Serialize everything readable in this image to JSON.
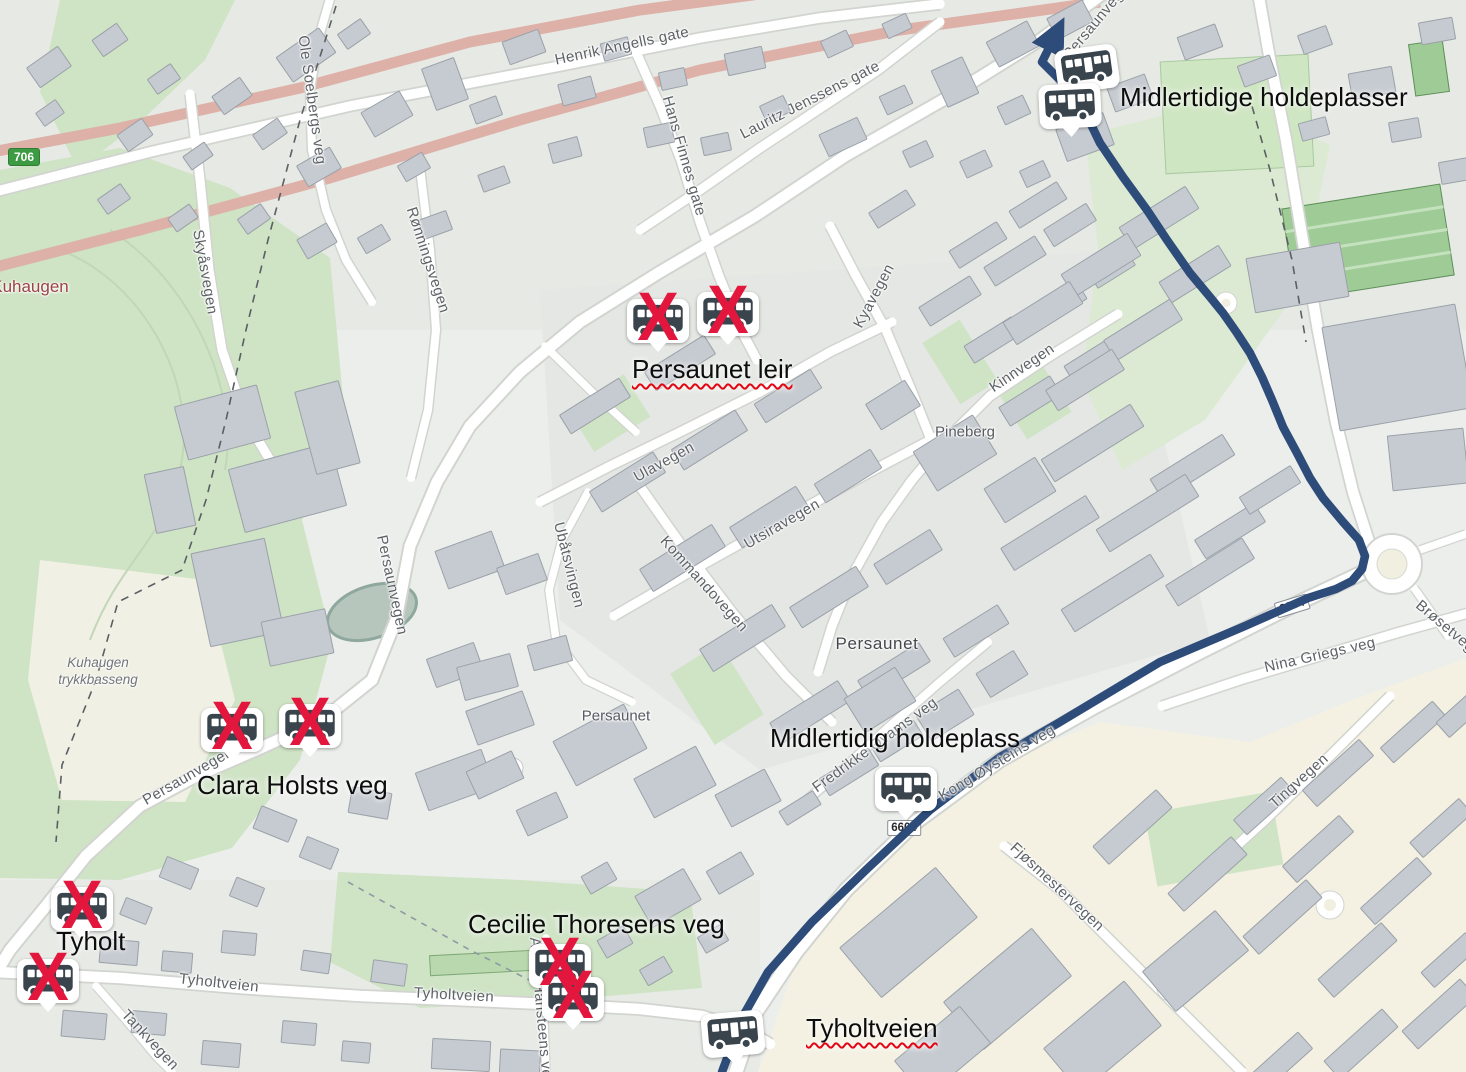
{
  "annotations": [
    {
      "text": "Midlertidige holdeplasser",
      "x": 1120,
      "y": 82,
      "spellcheck": false
    },
    {
      "text": "Persaunet leir",
      "x": 632,
      "y": 354,
      "spellcheck": true
    },
    {
      "text": "Clara Holsts veg",
      "x": 197,
      "y": 770,
      "spellcheck": false
    },
    {
      "text": "Midlertidig holdeplass",
      "x": 770,
      "y": 723,
      "spellcheck": false
    },
    {
      "text": "Tyholt",
      "x": 56,
      "y": 926,
      "spellcheck": false
    },
    {
      "text": "Cecilie Thoresens veg",
      "x": 468,
      "y": 909,
      "spellcheck": false
    },
    {
      "text": "Tyholtveien",
      "x": 806,
      "y": 1013,
      "spellcheck": true
    }
  ],
  "bus_stops": [
    {
      "x": 1087,
      "y": 69,
      "crossed": false,
      "rot": -8
    },
    {
      "x": 1070,
      "y": 106,
      "crossed": false,
      "rot": -3
    },
    {
      "x": 658,
      "y": 321,
      "crossed": true,
      "rot": 0
    },
    {
      "x": 728,
      "y": 314,
      "crossed": true,
      "rot": 0
    },
    {
      "x": 232,
      "y": 730,
      "crossed": true,
      "rot": 0
    },
    {
      "x": 310,
      "y": 726,
      "crossed": true,
      "rot": 0
    },
    {
      "x": 82,
      "y": 909,
      "crossed": true,
      "rot": 0
    },
    {
      "x": 48,
      "y": 981,
      "crossed": true,
      "rot": 0
    },
    {
      "x": 560,
      "y": 966,
      "crossed": true,
      "rot": 0
    },
    {
      "x": 573,
      "y": 999,
      "crossed": true,
      "rot": 0
    },
    {
      "x": 906,
      "y": 789,
      "crossed": false,
      "rot": 0
    },
    {
      "x": 733,
      "y": 1034,
      "crossed": false,
      "rot": -5
    }
  ],
  "street_labels": [
    {
      "text": "Henrik Angells gate",
      "x": 622,
      "y": 46,
      "rot": -12
    },
    {
      "text": "Hans Finnes gate",
      "x": 684,
      "y": 156,
      "rot": 74
    },
    {
      "text": "Lauritz Jenssens gate",
      "x": 810,
      "y": 100,
      "rot": -27
    },
    {
      "text": "Persaunvegen",
      "x": 1099,
      "y": 18,
      "rot": -50
    },
    {
      "text": "Kyavegen",
      "x": 874,
      "y": 296,
      "rot": -62
    },
    {
      "text": "Kinnvegen",
      "x": 1022,
      "y": 368,
      "rot": -34
    },
    {
      "text": "Ulavegen",
      "x": 664,
      "y": 462,
      "rot": -29
    },
    {
      "text": "Ubåtsvingen",
      "x": 569,
      "y": 565,
      "rot": 76
    },
    {
      "text": "Kommandovegen",
      "x": 704,
      "y": 584,
      "rot": 48
    },
    {
      "text": "Utsiravegen",
      "x": 782,
      "y": 524,
      "rot": -30
    },
    {
      "text": "Ole Soelbergs veg",
      "x": 312,
      "y": 100,
      "rot": 82
    },
    {
      "text": "Skyåsvegen",
      "x": 205,
      "y": 272,
      "rot": 80
    },
    {
      "text": "Rønningsvegen",
      "x": 428,
      "y": 260,
      "rot": 72
    },
    {
      "text": "Persaunvegen",
      "x": 392,
      "y": 585,
      "rot": 78
    },
    {
      "text": "Persaunvegen",
      "x": 188,
      "y": 776,
      "rot": -30
    },
    {
      "text": "Fredrikke Qvams veg",
      "x": 875,
      "y": 745,
      "rot": -36
    },
    {
      "text": "Kong Øysteins veg",
      "x": 997,
      "y": 763,
      "rot": -31
    },
    {
      "text": "Nina Griegs veg",
      "x": 1320,
      "y": 655,
      "rot": -13
    },
    {
      "text": "Brøsetvegen",
      "x": 1452,
      "y": 632,
      "rot": 40
    },
    {
      "text": "Tingvegen",
      "x": 1299,
      "y": 781,
      "rot": -42
    },
    {
      "text": "Fjøsmestervegen",
      "x": 1057,
      "y": 887,
      "rot": 43
    },
    {
      "text": "Tyholtveien",
      "x": 219,
      "y": 983,
      "rot": 6
    },
    {
      "text": "Tyholtveien",
      "x": 454,
      "y": 995,
      "rot": 3
    },
    {
      "text": "Tankvegen",
      "x": 150,
      "y": 1040,
      "rot": 47
    },
    {
      "text": "Aasta Hansteens veg",
      "x": 541,
      "y": 1012,
      "rot": 85
    }
  ],
  "place_labels": [
    {
      "text": "Kuhaugen",
      "x": 30,
      "y": 287,
      "style": "place-red"
    },
    {
      "text": "Kuhaugen",
      "line2": "trykkbasseng",
      "x": 98,
      "y": 672,
      "style": "place-italic"
    },
    {
      "text": "Pineberg",
      "x": 965,
      "y": 432,
      "style": "place-gray"
    },
    {
      "text": "Persaunet",
      "x": 877,
      "y": 644,
      "style": "place-dark"
    },
    {
      "text": "Persaunet",
      "x": 616,
      "y": 716,
      "style": "place-gray"
    }
  ],
  "shields": [
    {
      "text": "706",
      "style": "green",
      "x": 24,
      "y": 157,
      "rot": 0
    },
    {
      "text": "6604",
      "style": "white",
      "x": 1292,
      "y": 606,
      "rot": -17
    },
    {
      "text": "6604",
      "style": "white",
      "x": 904,
      "y": 828,
      "rot": 0
    }
  ],
  "route": {
    "color": "#2e4c7a",
    "width": 8.5,
    "points": "722,1072 742,1018 768,972 812,922 868,868 930,810 1000,757 1060,722 1160,662 1245,626 1308,598 1336,589 1352,581 1362,569 1365,556 1359,540 1343,522 1323,498 1310,478 1297,453 1283,427 1272,400 1262,377 1250,353 1237,333 1223,313 1210,297 1190,273 1167,240 1147,210 1123,177 1100,143 1085,112 1068,88 1052,72 1042,62 1050,46"
  },
  "colors": {
    "route": "#2e4c7a",
    "cross": "#e3173d",
    "bus_icon": "#39444d",
    "marker_background": "#ffffff",
    "shield_green": "#3d9b44",
    "park_green": "#cfe3c5",
    "building_gray": "#c6cbd1",
    "construction_road_pink": "#ddb1a8"
  }
}
